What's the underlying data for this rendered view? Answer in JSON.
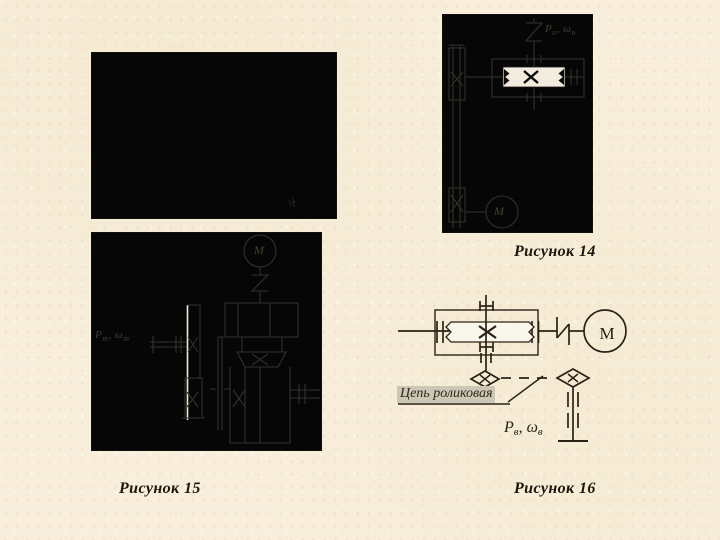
{
  "figure14": {
    "caption": "Рисунок 14",
    "motor_label": "М",
    "power_label": {
      "p": "P",
      "p_sub": "н",
      "comma": ", ",
      "omega": "ω",
      "omega_sub": "н"
    }
  },
  "figure15": {
    "caption": "Рисунок 15",
    "motor_label": "М",
    "power_label": {
      "p": "P",
      "p_sub": "т",
      "comma": ", ",
      "omega": "ω",
      "omega_sub": "т"
    }
  },
  "figure16": {
    "caption": "Рисунок 16",
    "motor_label": "М",
    "chain_label": "Цепь роликовая",
    "power_label": {
      "p": "P",
      "p_sub": "в",
      "comma": ", ",
      "omega": "ω",
      "omega_sub": "в"
    }
  },
  "colors": {
    "slide_background": "#f8eedb",
    "image_background": "#060606",
    "dim_diagram_line": "#33312a",
    "dark_diagram_line": "#2b2115",
    "white_element": "#f2ecdf",
    "chain_label_highlight": "#ccc6b5",
    "caption_text": "#1d140b"
  }
}
